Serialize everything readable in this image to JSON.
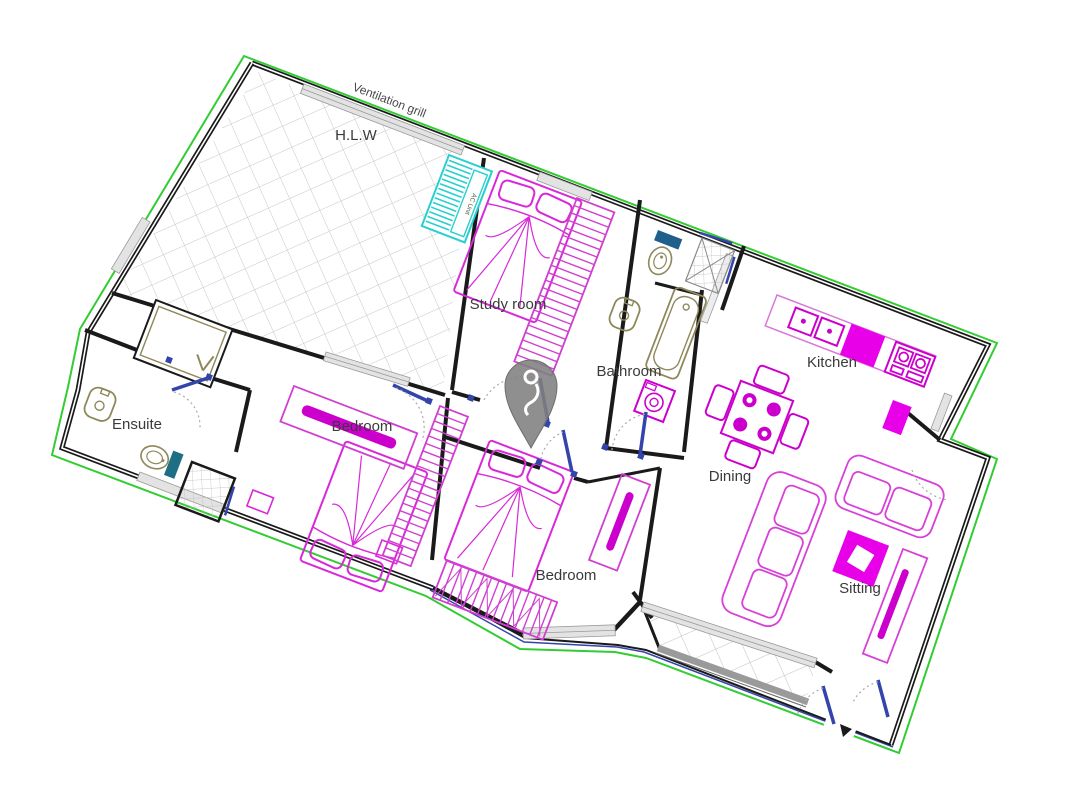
{
  "document": {
    "type": "apartment-floor-plan"
  },
  "rooms": {
    "hlw": "H.L.W",
    "study": "Study room",
    "bathroom": "Bathroom",
    "kitchen": "Kitchen",
    "ensuite": "Ensuite",
    "bedroom_left": "Bedroom",
    "bedroom_center": "Bedroom",
    "dining": "Dining",
    "sitting": "Sitting"
  },
  "annotations": {
    "ventilation_grill": "Ventilation grill",
    "ac_unit": "AC Unit"
  },
  "marker": {
    "name": "location-pin"
  },
  "colors": {
    "boundary_green": "#33CC33",
    "wall_black": "#1A1A1A",
    "furniture_magenta": "#CC00CC",
    "furniture_light": "#D84ED8",
    "fixture_olive": "#8E885A",
    "door_blue": "#3344AA",
    "ac_cyan": "#29CFCF",
    "toilet_teal": "#1E6F85",
    "pin_gray": "#7F7F7F"
  }
}
